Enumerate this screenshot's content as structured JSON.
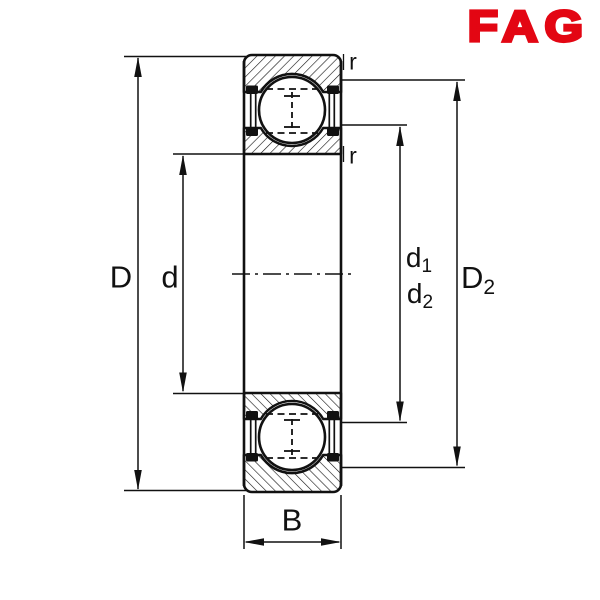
{
  "logo": {
    "text": "FAG",
    "color": "#e30613"
  },
  "drawing": {
    "background": "#ffffff",
    "line_color": "#111111",
    "labels": {
      "D": "D",
      "d": "d",
      "d1": {
        "base": "d",
        "sub": "1"
      },
      "d2": {
        "base": "d",
        "sub": "2"
      },
      "D2": {
        "base": "D",
        "sub": "2"
      },
      "B": "B",
      "r_top": "r",
      "r_bottom": "r"
    }
  }
}
